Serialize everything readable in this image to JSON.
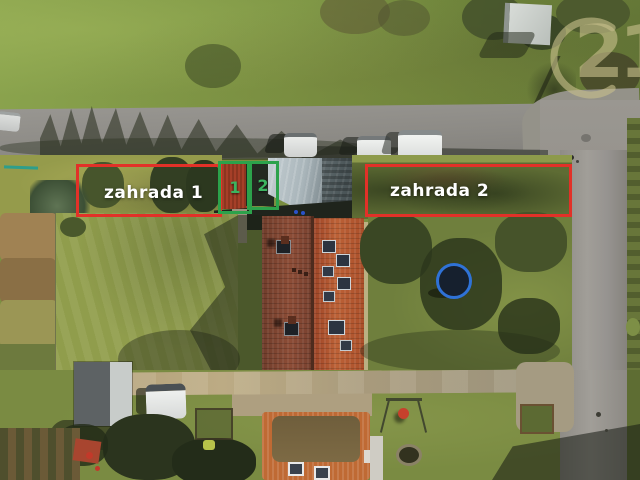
{
  "photo": {
    "type": "aerial-drone-photo",
    "subject": "village street with gardens and red-roofed house"
  },
  "annotations": {
    "garden1": {
      "label": "zahrada 1",
      "box_color": "#e23128",
      "text_color": "#ffffff"
    },
    "garden2": {
      "label": "zahrada 2",
      "box_color": "#e23128",
      "text_color": "#ffffff"
    },
    "plot1": {
      "label": "1",
      "box_color": "#2ca24b",
      "text_color": "#3cb45f"
    },
    "plot2": {
      "label": "2",
      "box_color": "#2ca24b",
      "text_color": "#3cb45f"
    }
  },
  "watermark": {
    "brand": "Century 21",
    "digits": "21",
    "color": "#c7bf8a"
  }
}
